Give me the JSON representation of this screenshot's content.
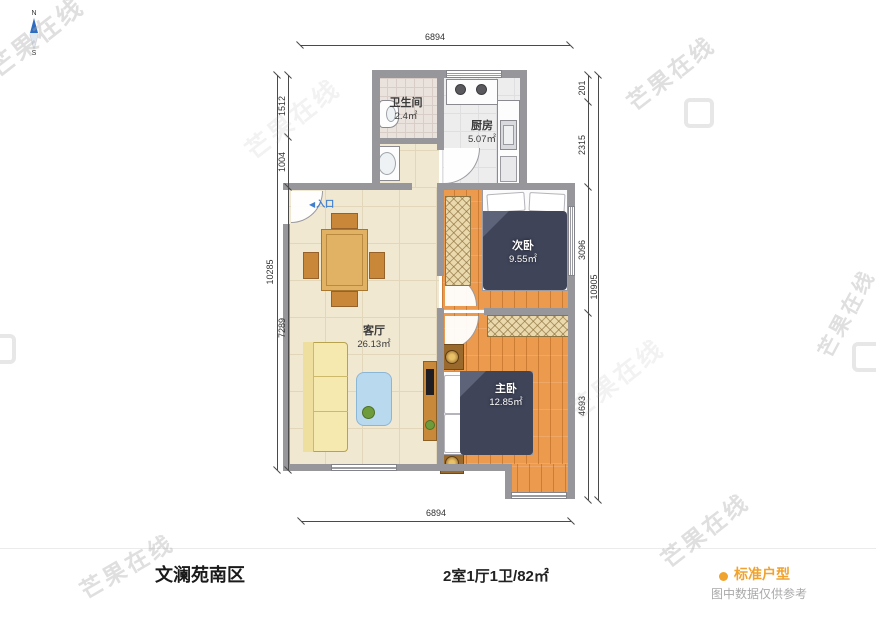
{
  "compass": {
    "north": "N",
    "south": "S"
  },
  "entrance": {
    "arrow": "◀",
    "label": "入口"
  },
  "dimensions": {
    "top": "6894",
    "bottom": "6894",
    "left_total": "10285",
    "left_segments": [
      "1512",
      "1004",
      "7289"
    ],
    "right_total": "10905",
    "right_segments": [
      "201",
      "2315",
      "3096",
      "4693"
    ]
  },
  "rooms": {
    "bathroom": {
      "name": "卫生间",
      "area": "2.4㎡"
    },
    "kitchen": {
      "name": "厨房",
      "area": "5.07㎡"
    },
    "living": {
      "name": "客厅",
      "area": "26.13㎡"
    },
    "second_bedroom": {
      "name": "次卧",
      "area": "9.55㎡"
    },
    "master_bedroom": {
      "name": "主卧",
      "area": "12.85㎡"
    }
  },
  "footer": {
    "community_name": "文澜苑南区",
    "layout_summary": "2室1厅1卫/82㎡",
    "type_label": "标准户型",
    "disclaimer": "图中数据仅供参考"
  },
  "watermark": {
    "text": "芒果在线"
  },
  "colors": {
    "accent_orange": "#F0A32F",
    "entrance_blue": "#3E7FD0",
    "wood_floor": "#EC9A4E",
    "bed_navy": "#3F4459",
    "wall_gray": "#97979B"
  }
}
